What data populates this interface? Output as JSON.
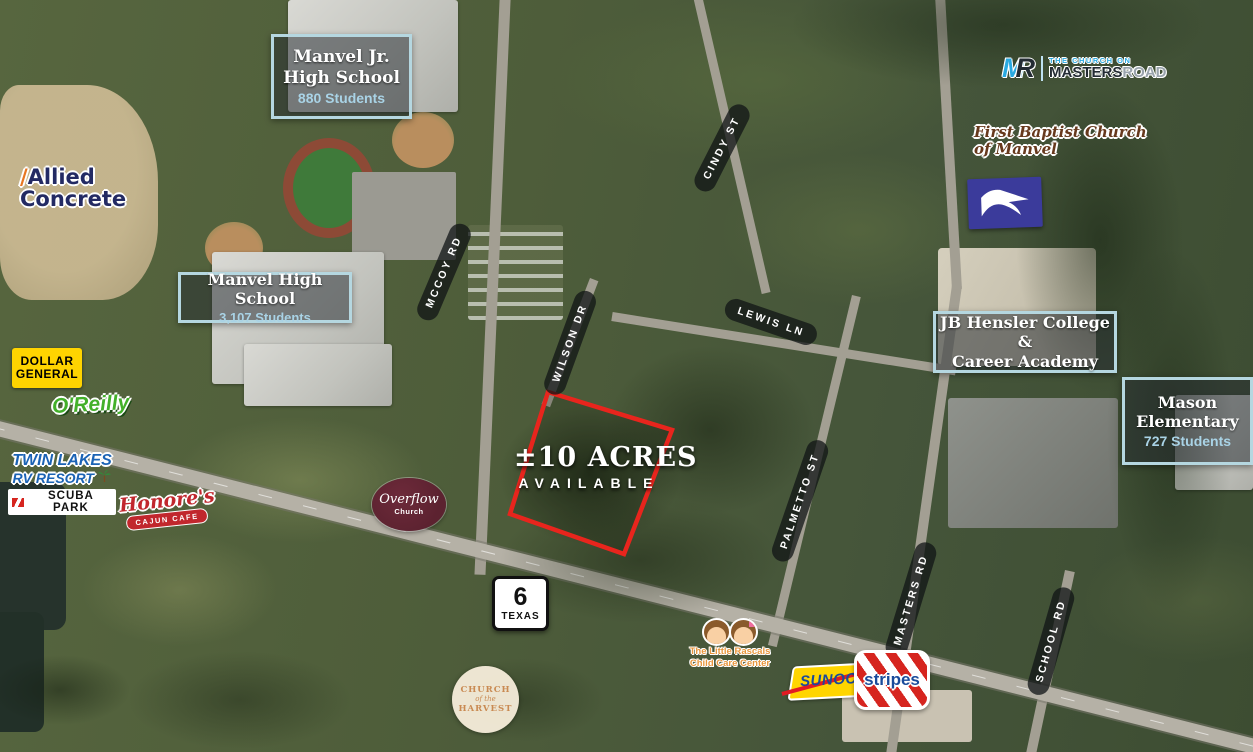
{
  "map": {
    "headline": "±10 ACRES",
    "subheadline": "AVAILABLE"
  },
  "schools": {
    "jr_high": {
      "line1": "Manvel Jr.",
      "line2": "High School",
      "students": "880 Students"
    },
    "high": {
      "line1": "Manvel High School",
      "students": "3,107 Students"
    },
    "hensler": {
      "line1": "JB Hensler College &",
      "line2": "Career Academy"
    },
    "mason": {
      "line1": "Mason",
      "line2": "Elementary",
      "students": "727 Students"
    }
  },
  "roads": {
    "mccoy": "MCCOY RD",
    "cindy": "CINDY ST",
    "wilson": "WILSON DR",
    "lewis": "LEWIS LN",
    "palmetto": "PALMETTO ST",
    "masters": "MASTERS RD",
    "school": "SCHOOL RD"
  },
  "highway_shield": {
    "number": "6",
    "state": "TEXAS"
  },
  "businesses": {
    "allied": {
      "line1": "Allied",
      "line2": "Concrete"
    },
    "dollar_general": {
      "line1": "DOLLAR",
      "line2": "GENERAL"
    },
    "oreilly": "O'Reilly",
    "twin_lakes": {
      "line1": "TWIN LAKES",
      "line2": "RV RESORT",
      "line3": "SCUBA PARK"
    },
    "honores": {
      "line1": "Honore's",
      "line2": "CAJUN CAFE"
    },
    "overflow": {
      "line1": "Overflow",
      "line2": "Church"
    },
    "harvest": {
      "line1": "CHURCH",
      "line2": "of the",
      "line3": "HARVEST"
    },
    "little_rascals": {
      "line1": "The Little Rascals",
      "line2": "Child Care Center"
    },
    "sunoco": "SUNOCO",
    "stripes": "stripes",
    "masters_road_church": {
      "monogram_m": "M",
      "monogram_r": "R",
      "line1": "THE CHURCH ON",
      "line2": "MASTERS",
      "line2b": "ROAD"
    },
    "first_baptist": {
      "line1": "First Baptist Church",
      "line2": "of Manvel"
    }
  },
  "colors": {
    "parcel_outline": "#e8251d",
    "info_box_border": "#b5d7e0",
    "students_text": "#a9d3e6",
    "road_pill_bg": "rgba(16,20,22,0.75)",
    "dollar_general_yellow": "#ffd400",
    "oreilly_green": "#43b02a",
    "usps_blue": "#3b3b9b",
    "overflow_maroon": "#5c2230",
    "sunoco_yellow": "#ffd500",
    "sunoco_blue": "#1a4b9b",
    "stripes_red": "#d6251f",
    "twin_lakes_blue": "#1b63b5",
    "honores_red": "#c1272d",
    "harvest_orange": "#c98a52",
    "first_baptist_brown": "#67391d",
    "masters_m_blue": "#2aa9e0"
  }
}
